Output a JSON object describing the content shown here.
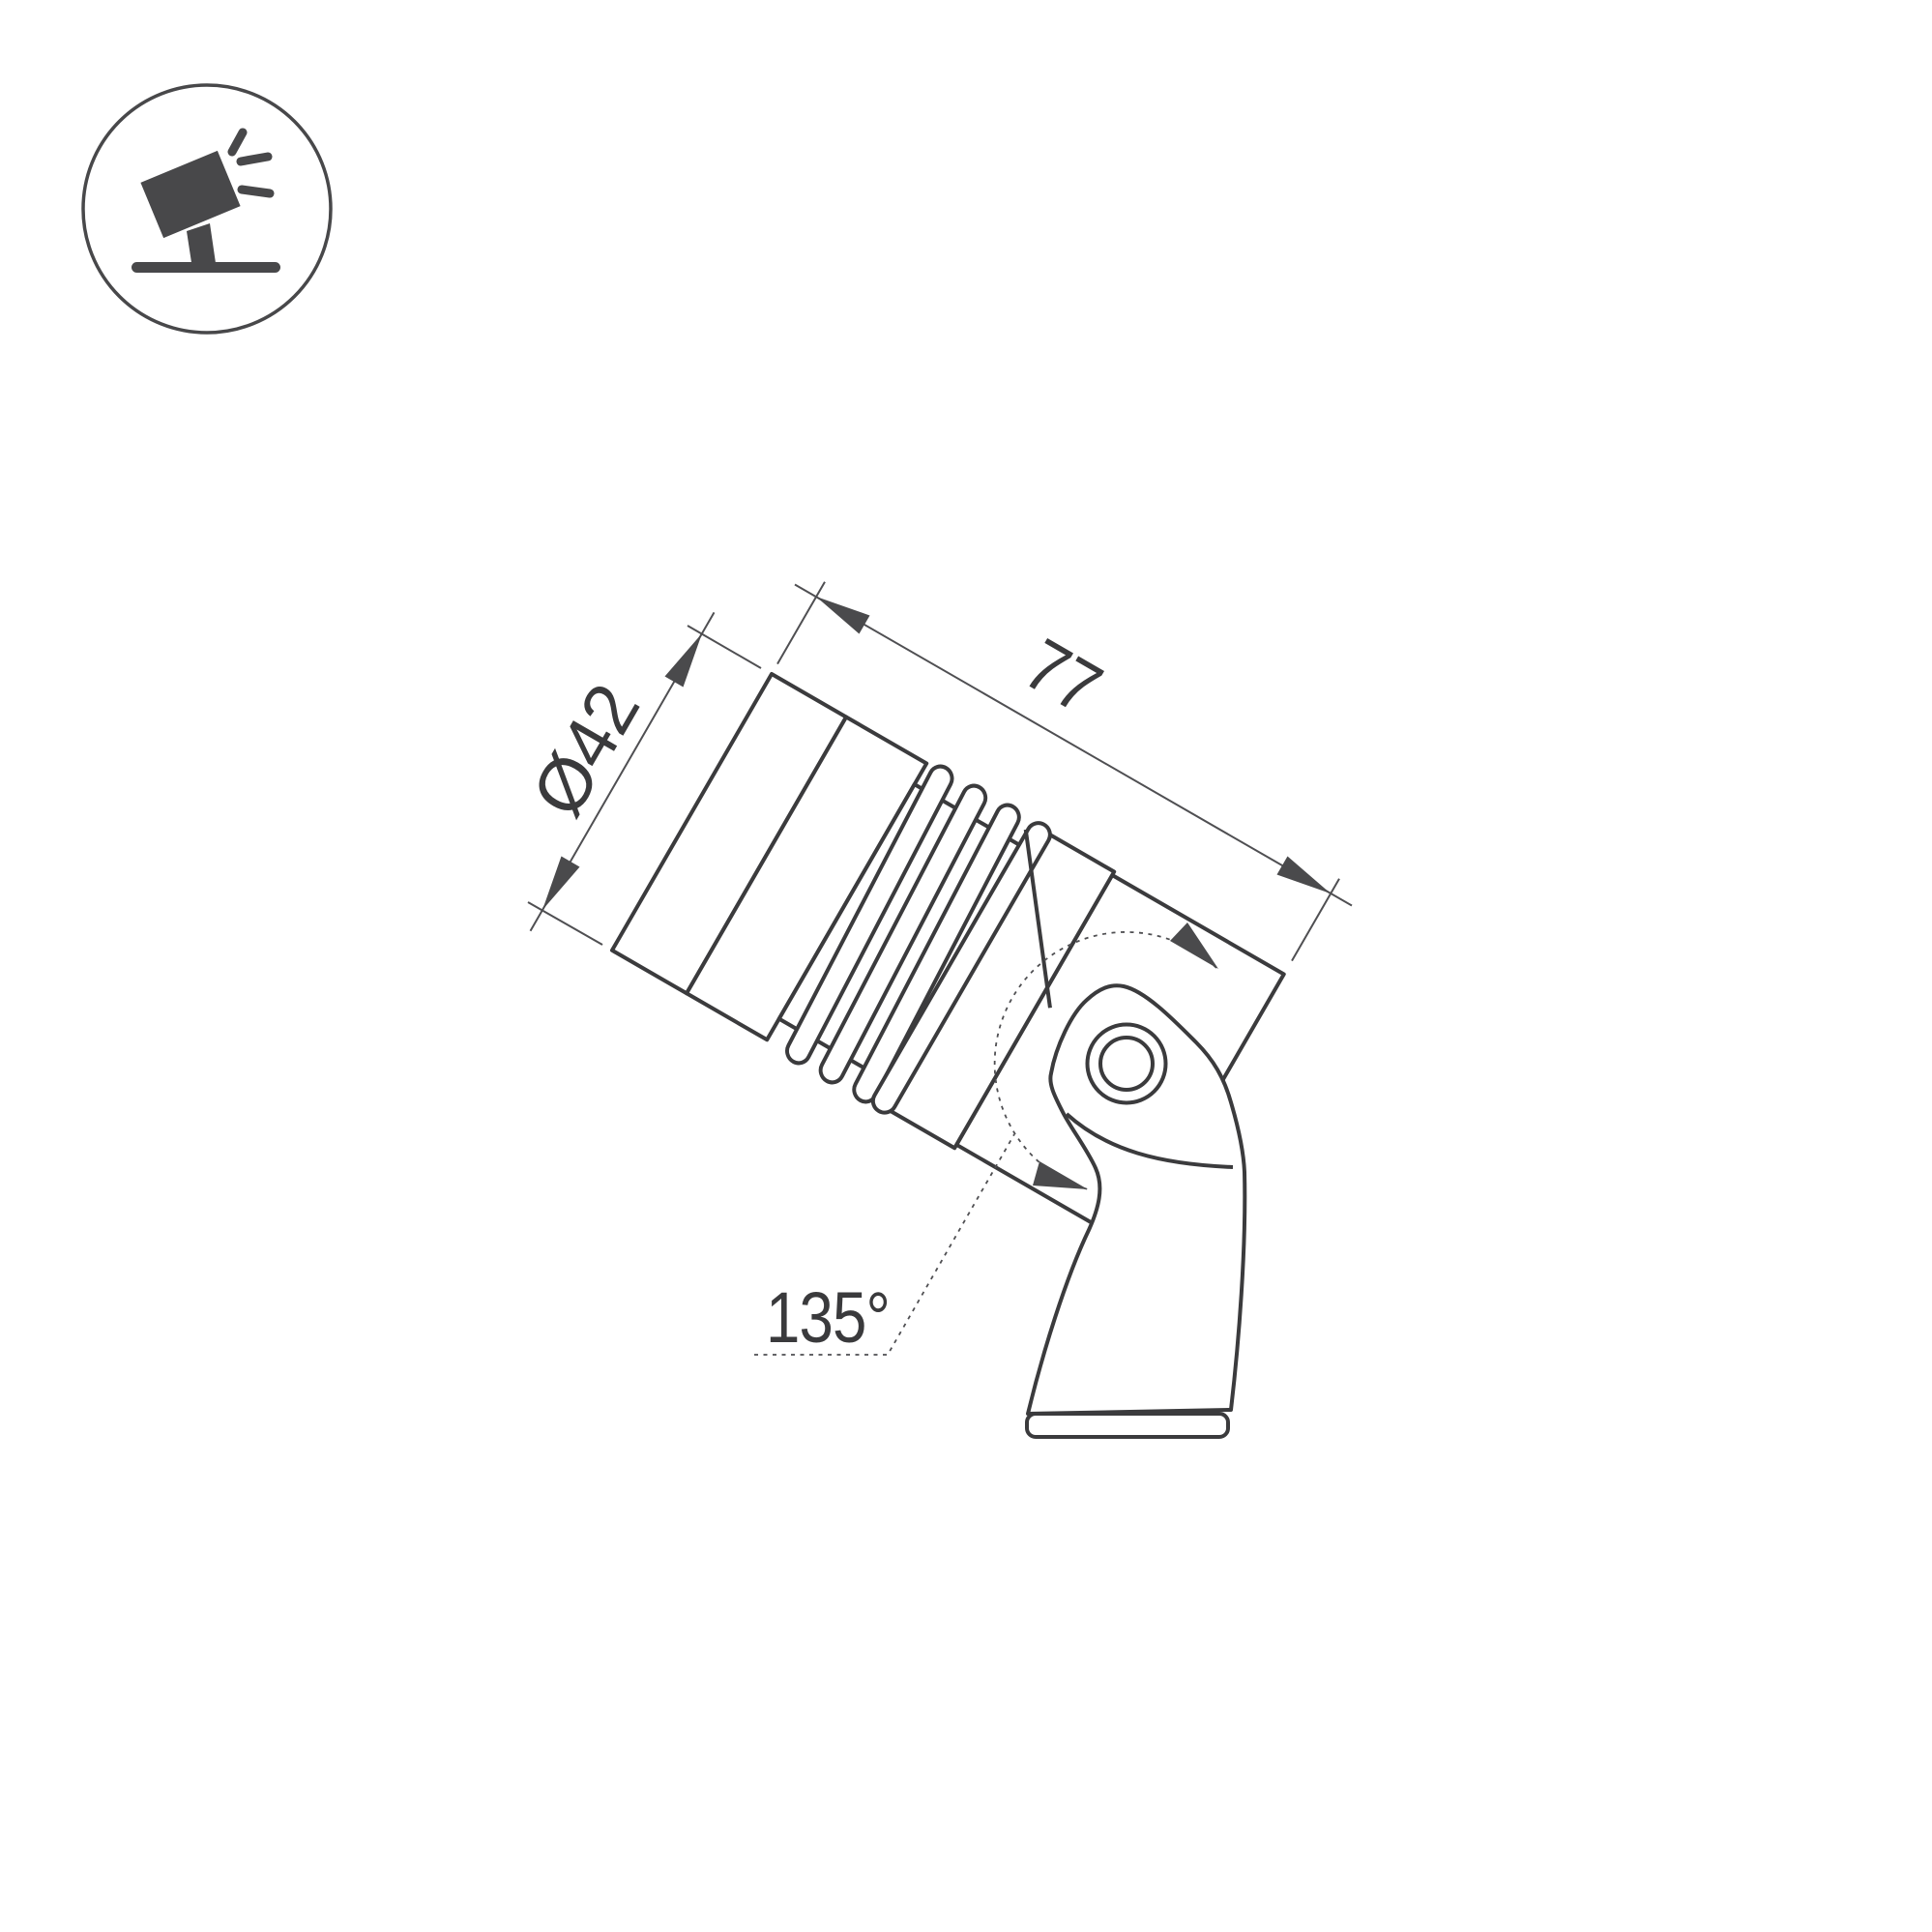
{
  "page": {
    "background": "#ffffff"
  },
  "icon": {
    "name": "adjustable-ground-spotlight-pictogram",
    "color": "#48484a"
  },
  "drawing": {
    "type": "technical-dimension-drawing",
    "subject": "adjustable spotlight side view with mounting bracket",
    "line_color": "#3b3b3d",
    "thin_line_color": "#4f4f52",
    "text_color": "#3a3a3c",
    "labels": {
      "diameter": "Ø42",
      "length": "77",
      "angle": "135°"
    },
    "values": {
      "diameter_mm": 42,
      "length_mm": 77,
      "tilt_range_deg": 135
    }
  }
}
